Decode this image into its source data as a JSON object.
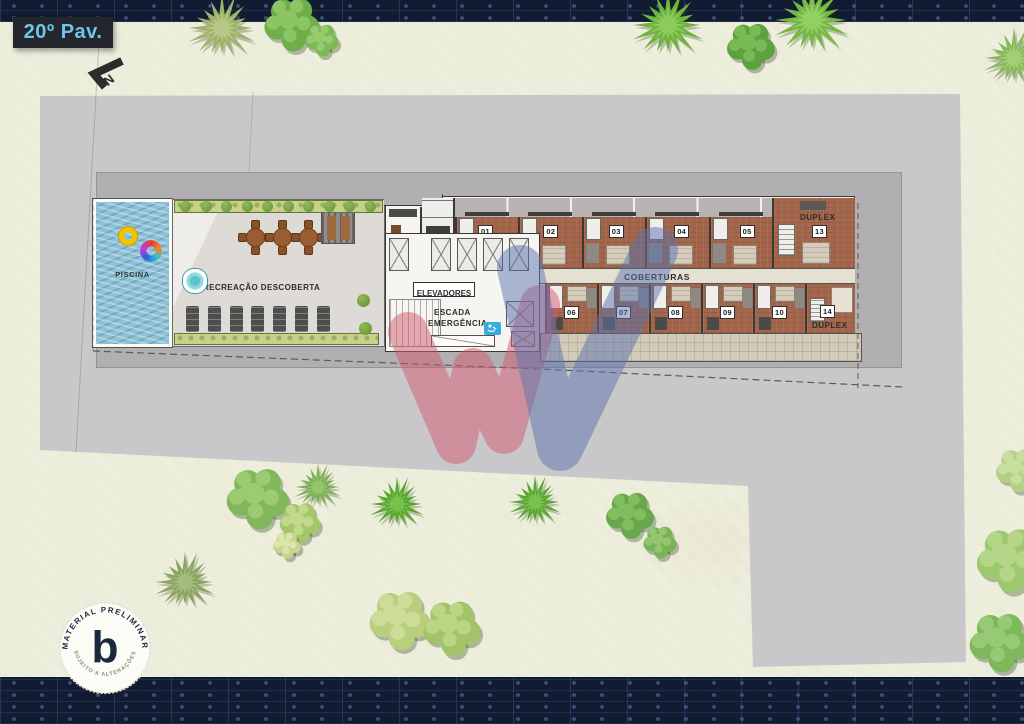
{
  "badge": {
    "label": "20º Pav."
  },
  "compass": {
    "label": "N"
  },
  "plan": {
    "pool_label": "PISCINA",
    "outdoor_label": "RECREAÇÃO DESCOBERTA",
    "covered_line1": "RECREAÇÃO",
    "covered_line2": "COBERTA",
    "elevators_label": "ELEVADORES",
    "stairs_line1": "ESCADA",
    "stairs_line2": "EMERGÊNCIA",
    "corridor_label": "COBERTURAS",
    "units_top": [
      "01",
      "02",
      "03",
      "04",
      "05"
    ],
    "units_bottom": [
      "06",
      "07",
      "08",
      "09",
      "10"
    ],
    "duplex_top": {
      "word": "DUPLEX",
      "number": "13"
    },
    "duplex_bottom": {
      "number": "14",
      "word": "DUPLEX"
    }
  },
  "stamp": {
    "arc_top": "MATERIAL PRELIMINAR",
    "arc_bottom": "SUJEITO A ALTERAÇÕES",
    "monogram": "b"
  },
  "colors": {
    "badge_bg": "#23262d",
    "accent_blue": "#6ec6ea",
    "navy": "#111b32",
    "terrain": "#eeeedd",
    "slab": "#cac7ca",
    "slab_inner": "#b2afb2",
    "pool_blue": "#8fc1d6",
    "brick": "#a2654a",
    "hedge_green": "#c6d287",
    "watermark_red": "#cf5a6e",
    "watermark_blue": "#5a74ad",
    "accessibility_badge": "#35aede"
  }
}
